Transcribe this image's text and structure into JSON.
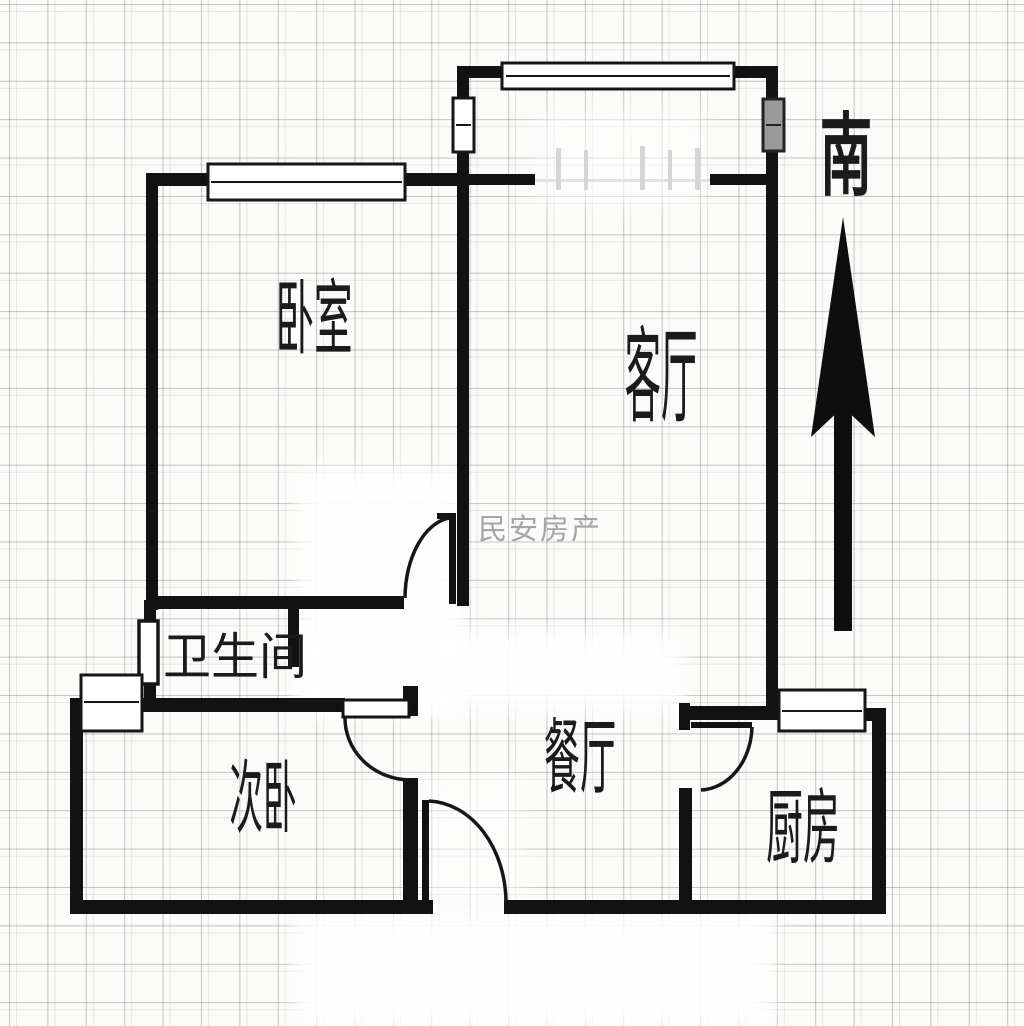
{
  "plan": {
    "watermark": "民安房产",
    "compass": {
      "south_label": "南"
    },
    "rooms": [
      {
        "id": "master-bedroom",
        "label": "卧室"
      },
      {
        "id": "living-room",
        "label": "客厅"
      },
      {
        "id": "bathroom",
        "label": "卫生间"
      },
      {
        "id": "second-bedroom",
        "label": "次卧"
      },
      {
        "id": "dining-room",
        "label": "餐厅"
      },
      {
        "id": "kitchen",
        "label": "厨房"
      }
    ],
    "colors": {
      "wall": "#121212",
      "grid_line": "#b9b9b9",
      "paper": "#fbfbf9",
      "watermark": "#a5a5a5",
      "shaded_window_fill": "#9a9a9a"
    }
  }
}
